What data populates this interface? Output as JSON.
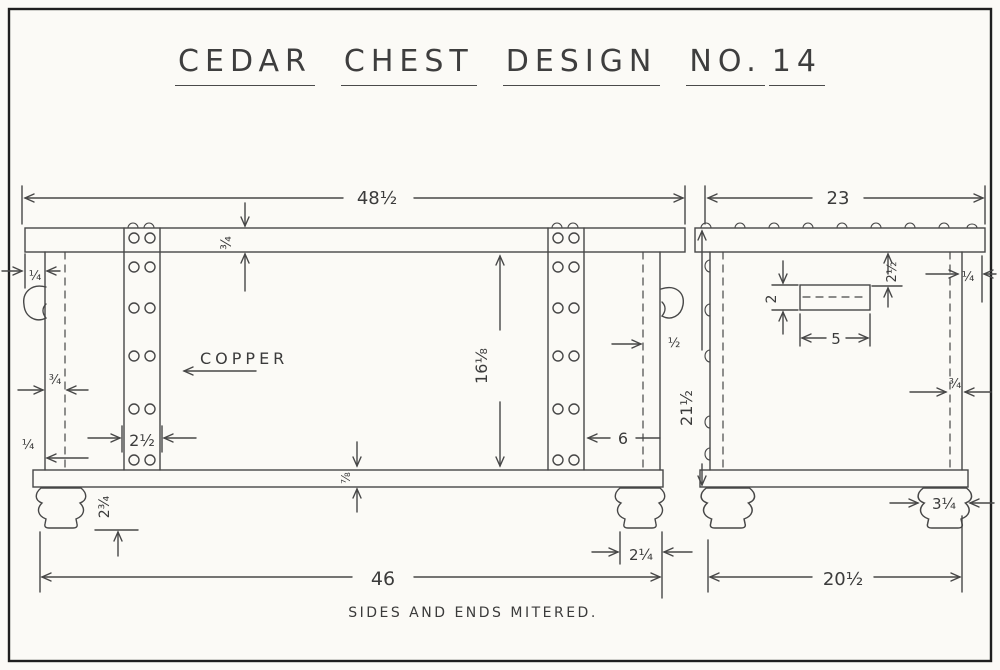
{
  "title": {
    "words": [
      "CEDAR",
      "CHEST",
      "DESIGN",
      "NO.",
      "14"
    ]
  },
  "front_view": {
    "label": "COPPER",
    "dims": {
      "lid_length": "48½",
      "lid_thickness": "¾",
      "lid_overhang": "¼",
      "side_wall": "¾",
      "bottom_edge": "¼",
      "strap_width": "2½",
      "panel_height": "16⅛",
      "end_thickness": "½",
      "overall_height": "21½",
      "strap_inset": "6",
      "bottom_thickness": "⅞",
      "foot_height": "2¾",
      "foot_width": "2¼",
      "base_length": "46"
    }
  },
  "side_view": {
    "dims": {
      "top_depth": "23",
      "plate_height": "2",
      "plate_width": "5",
      "plate_offset": "2½",
      "lid_overhang": "¼",
      "wall_thickness": "¾",
      "foot_width": "3¼",
      "base_depth": "20½"
    }
  },
  "note": "SIDES AND ENDS MITERED."
}
